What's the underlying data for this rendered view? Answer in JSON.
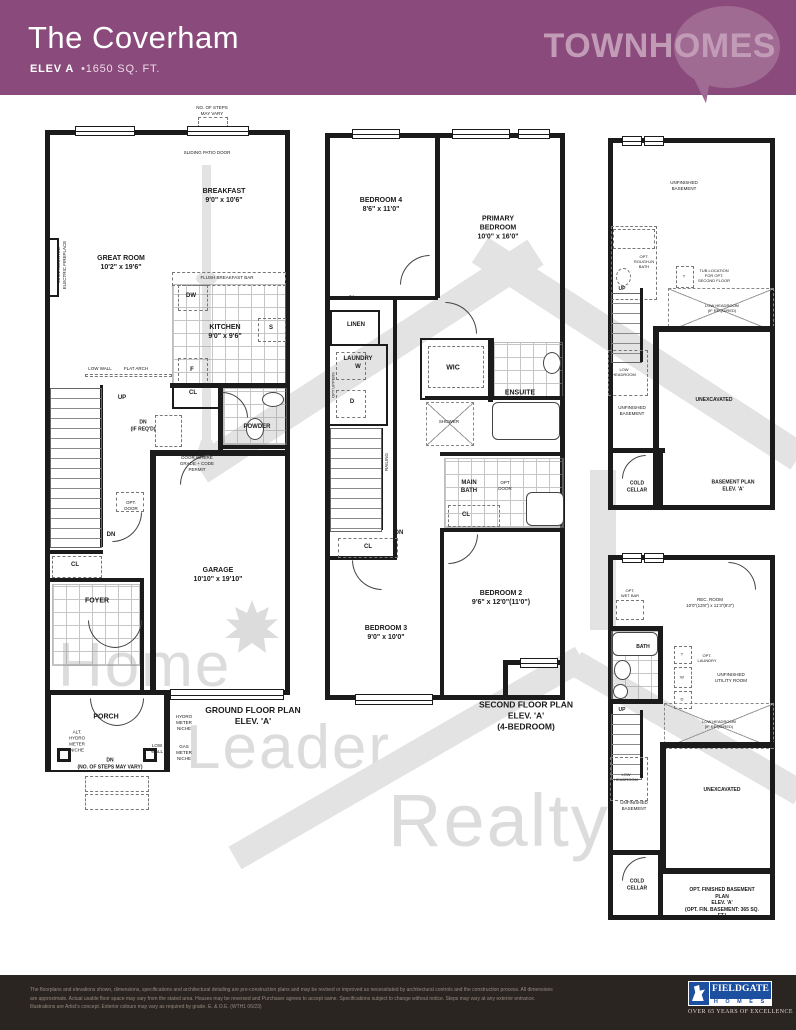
{
  "colors": {
    "header_bg": "#8a4a7c",
    "brand_text": "#c29cb7",
    "bubble": "#a06b93",
    "footer_bg": "#2b2521",
    "fieldgate_blue": "#1d4fa1",
    "wall": "#1b1b1b",
    "watermark": "#dcdcdc"
  },
  "header": {
    "title": "The Coverham",
    "elev": "ELEV A",
    "sqft": "•1650 SQ. FT.",
    "brand": "TOWNHOMES"
  },
  "watermark": {
    "w1": "Home",
    "w2": "Leader",
    "w3": "Realty"
  },
  "plans": {
    "ground": {
      "caption": "GROUND FLOOR PLAN\nELEV. 'A'",
      "labels": {
        "steps_note": "NO. OF STEPS\nMAY VARY",
        "sliding_door": "SLIDING PATIO DOOR",
        "breakfast": "BREAKFAST\n9'0\" x 10'6\"",
        "great_room": "GREAT ROOM\n10'2\" x 19'6\"",
        "fireplace": "WALL MOUNTED\nELECTRIC FIREPLACE",
        "flush_bar": "FLUSH BREAKFAST BAR",
        "dw": "DW",
        "kitchen": "KITCHEN\n9'0\" x 9'6\"",
        "sink": "S",
        "fridge": "F",
        "low_wall": "LOW WALL",
        "flat_arch": "FLAT ARCH",
        "up": "UP",
        "cl_kitchen": "CL",
        "dn_if_reqd": "DN\n(IF REQ'D)",
        "powder": "POWDER",
        "door_grade": "DOOR WHERE\nGRADE + CODE\nPERMIT",
        "opt_door": "OPT.\nDOOR",
        "dn": "DN",
        "cl_foyer": "CL",
        "foyer": "FOYER",
        "garage": "GARAGE\n10'10\" x 19'10\"",
        "porch": "PORCH",
        "alt_hydro": "ALT.\nHYDRO\nMETER\nNICHE",
        "dn_steps": "DN\n(NO. OF STEPS MAY VARY)",
        "low_wall2": "LOW\nWALL",
        "hydro_niche": "HYDRO\nMETER\nNICHE",
        "gas_niche": "GAS\nMETER\nNICHE"
      }
    },
    "second": {
      "caption": "SECOND FLOOR PLAN\nELEV. 'A'\n(4-BEDROOM)",
      "labels": {
        "bedroom4": "BEDROOM 4\n8'6\" x 11'0\"",
        "primary": "PRIMARY\nBEDROOM\n10'0\" x 16'0\"",
        "cl_top": "CL",
        "linen": "LINEN",
        "laundry": "LAUNDRY\nW",
        "dryer": "D",
        "opt_uppers": "OPT UPPERS",
        "wic": "WIC",
        "ensuite": "ENSUITE",
        "shower": "SHOWER",
        "railing": "RAILING",
        "main_bath": "MAIN\nBATH",
        "opt_door": "OPT\nDOOR",
        "cl_mid": "CL",
        "dn": "DN",
        "cl_low": "CL",
        "bedroom2": "BEDROOM 2\n9'6\" x 12'0\"(11'0\")",
        "bedroom3": "BEDROOM 3\n9'0\" x 10'0\""
      }
    },
    "basement": {
      "caption": "BASEMENT PLAN\nELEV. 'A'",
      "labels": {
        "unfinished_top": "UNFINISHED\nBASEMENT",
        "opt_bath": "OPT.\nROUGH-IN\nBATH",
        "tub_t": "T",
        "tub_note": "TUB LOCATION\nFOR OPT.\nSECOND FLOOR",
        "up": "UP",
        "low_headroom_req": "LOW HEADROOM\n(IF REQUIRED)",
        "low_headroom": "LOW\nHEADROOM",
        "unfinished": "UNFINISHED\nBASEMENT",
        "unexcavated": "UNEXCAVATED",
        "cold_cellar": "COLD\nCELLAR"
      }
    },
    "opt_basement": {
      "caption": "OPT. FINISHED BASEMENT PLAN\nELEV. 'A'\n(OPT. FIN. BASEMENT: 365 SQ. FT.)",
      "labels": {
        "opt_wet_bar": "OPT.\nWET BAR",
        "rec_room": "REC. ROOM\n10'0\"(13'8\") x 11'3\"(8'3\")",
        "bath": "BATH",
        "t": "T",
        "w": "W",
        "d": "D",
        "opt_laundry": "OPT.\nLAUNDRY",
        "utility": "UNFINISHED\nUTILITY ROOM",
        "up": "UP",
        "low_headroom_req": "LOW HEADROOM\n(IF REQUIRED)",
        "low_headroom": "LOW\nHEADROOM",
        "unfinished": "UNFINISHED\nBASEMENT",
        "unexcavated": "UNEXCAVATED",
        "cold_cellar": "COLD\nCELLAR"
      }
    }
  },
  "footer": {
    "disclaimer": "The floorplans and elevations shown, dimensions, specifications and architectural detailing are pre-construction plans and may be revised or improved as necessitated by architectural controls and the construction process. All dimensions are approximate. Actual usable floor space may vary from the stated area. Houses may be reversed and Purchaser agrees to accept same. Specifications subject to change without notice. Steps may vary at any exterior entrance. Illustrations are Artist's concept. Exterior colours may vary as required by grade. E. & O.E. (WTH1 06/23)",
    "brand": "FIELDGATE",
    "homes": "H O M E S",
    "tagline": "OVER 65 YEARS OF EXCELLENCE"
  }
}
